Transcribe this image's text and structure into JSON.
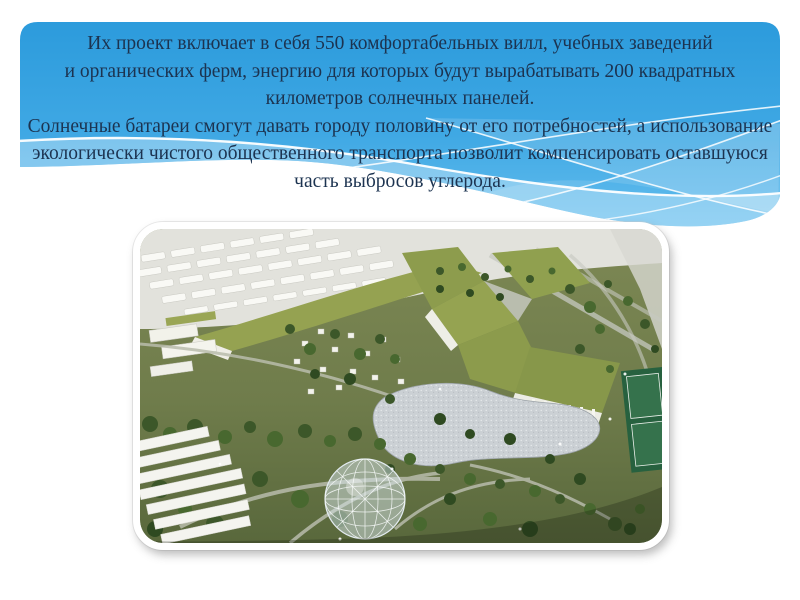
{
  "slide": {
    "background_color": "#FFFFFF",
    "banner": {
      "top_color": "#2C9BDC",
      "bottom_color": "#64BEEE",
      "text_color": "#1C3350",
      "lines": [
        "Их проект включает в себя 550 комфортабельных вилл, учебных заведений",
        "и органических ферм, энергию для которых будут вырабатывать 200 квадратных",
        "километров солнечных панелей.",
        "Солнечные батареи смогут давать городу половину от его потребностей, а использование",
        "экологически чистого общественного транспорта позволит компенсировать оставшуюся",
        "часть выбросов углерода."
      ]
    },
    "photo": {
      "name": "eco-city-aerial-model-photo",
      "frame_color": "#FFFFFF",
      "ground_color": "#76814F",
      "green_roof_color": "#94A351",
      "pond_color": "#CCD1D5",
      "building_color": "#F4F4EF",
      "tree_color": "#3C5729",
      "tennis_court_color": "#27613F"
    }
  }
}
